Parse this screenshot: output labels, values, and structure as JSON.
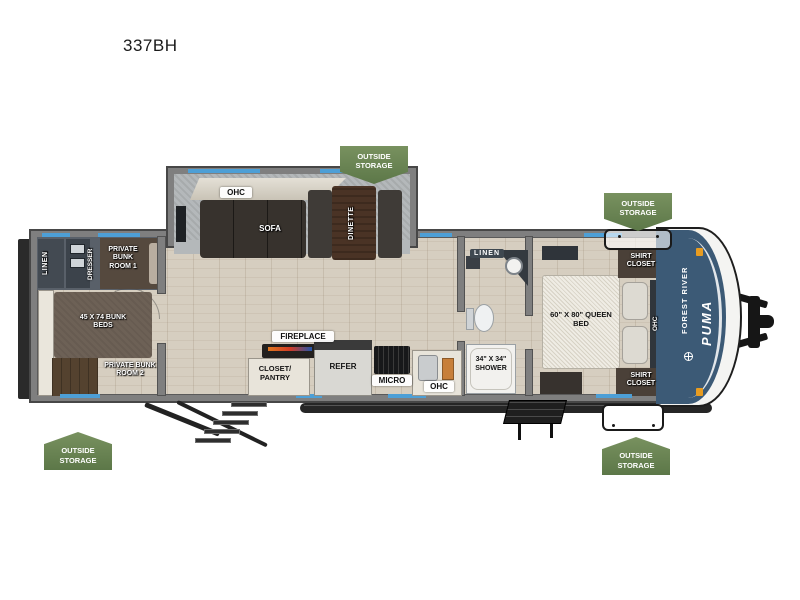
{
  "title": "337BH",
  "badge": {
    "outside_storage": "OUTSIDE STORAGE"
  },
  "front_cap": {
    "maker": "FOREST RIVER",
    "model": "PUMA"
  },
  "labels": {
    "linen_rear": "LINEN",
    "dresser": "DRESSER",
    "private_bunk_room_1": "PRIVATE BUNK ROOM 1",
    "bunk_beds": "45 X 74 BUNK BEDS",
    "private_bunk_room_2": "PRIVATE BUNK ROOM 2",
    "ohc_living": "OHC",
    "sofa": "SOFA",
    "dinette": "DINETTE",
    "fireplace": "FIREPLACE",
    "closet_pantry": "CLOSET/ PANTRY",
    "refer": "REFER",
    "micro": "MICRO",
    "ohc_kitchen": "OHC",
    "linen_bath": "LINEN",
    "shower": "34\" X 34\" SHOWER",
    "queen_bed": "60\" X 80\" QUEEN BED",
    "shirt_closet": "SHIRT CLOSET",
    "ohc_bedroom": "OHC"
  },
  "colors": {
    "badge_green": "#6d8a5a",
    "window_blue": "#4d9fd6",
    "cap_blue": "#3c5a76",
    "wall_gray": "#7f7f7f",
    "floor_tan": "#d6cec0"
  }
}
